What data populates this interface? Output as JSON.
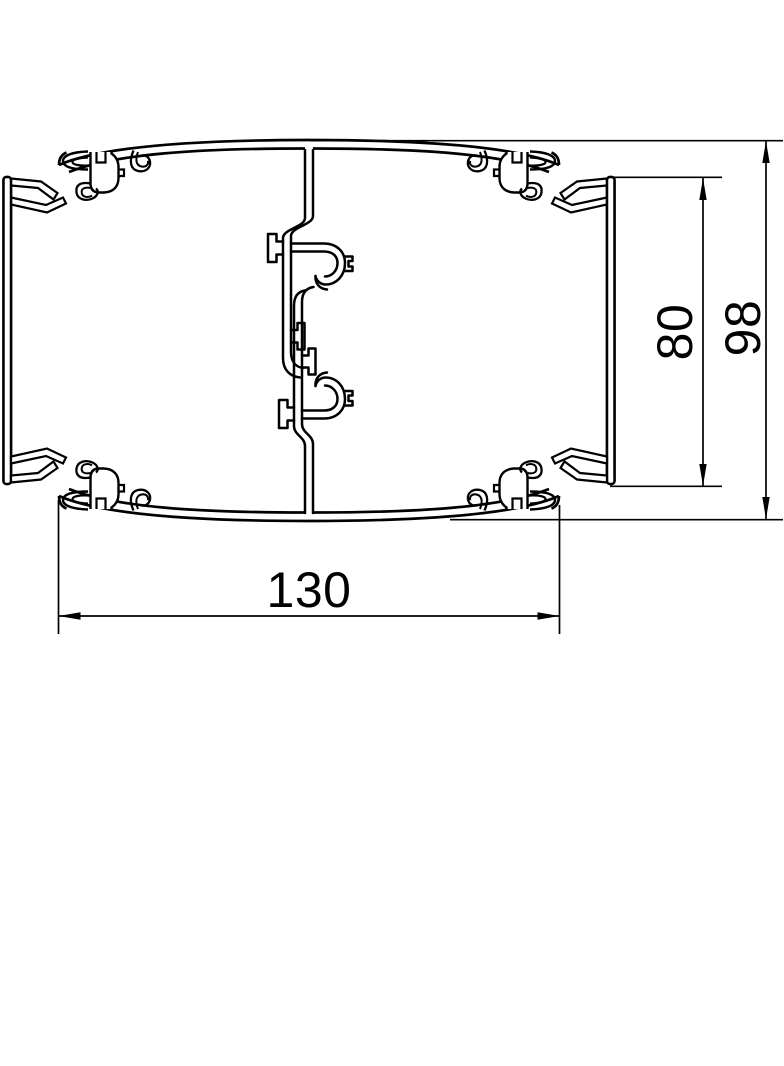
{
  "drawing": {
    "kind": "technical cross-section drawing of trunking profile",
    "background_color": "#ffffff",
    "line_color": "#000000",
    "dimensions": {
      "width": {
        "value": "130",
        "orientation": "horizontal",
        "position": "bottom"
      },
      "inner_height": {
        "value": "80",
        "orientation": "vertical-rotated",
        "position": "right-inner"
      },
      "overall_height": {
        "value": "98",
        "orientation": "vertical-rotated",
        "position": "right-outer"
      }
    }
  }
}
